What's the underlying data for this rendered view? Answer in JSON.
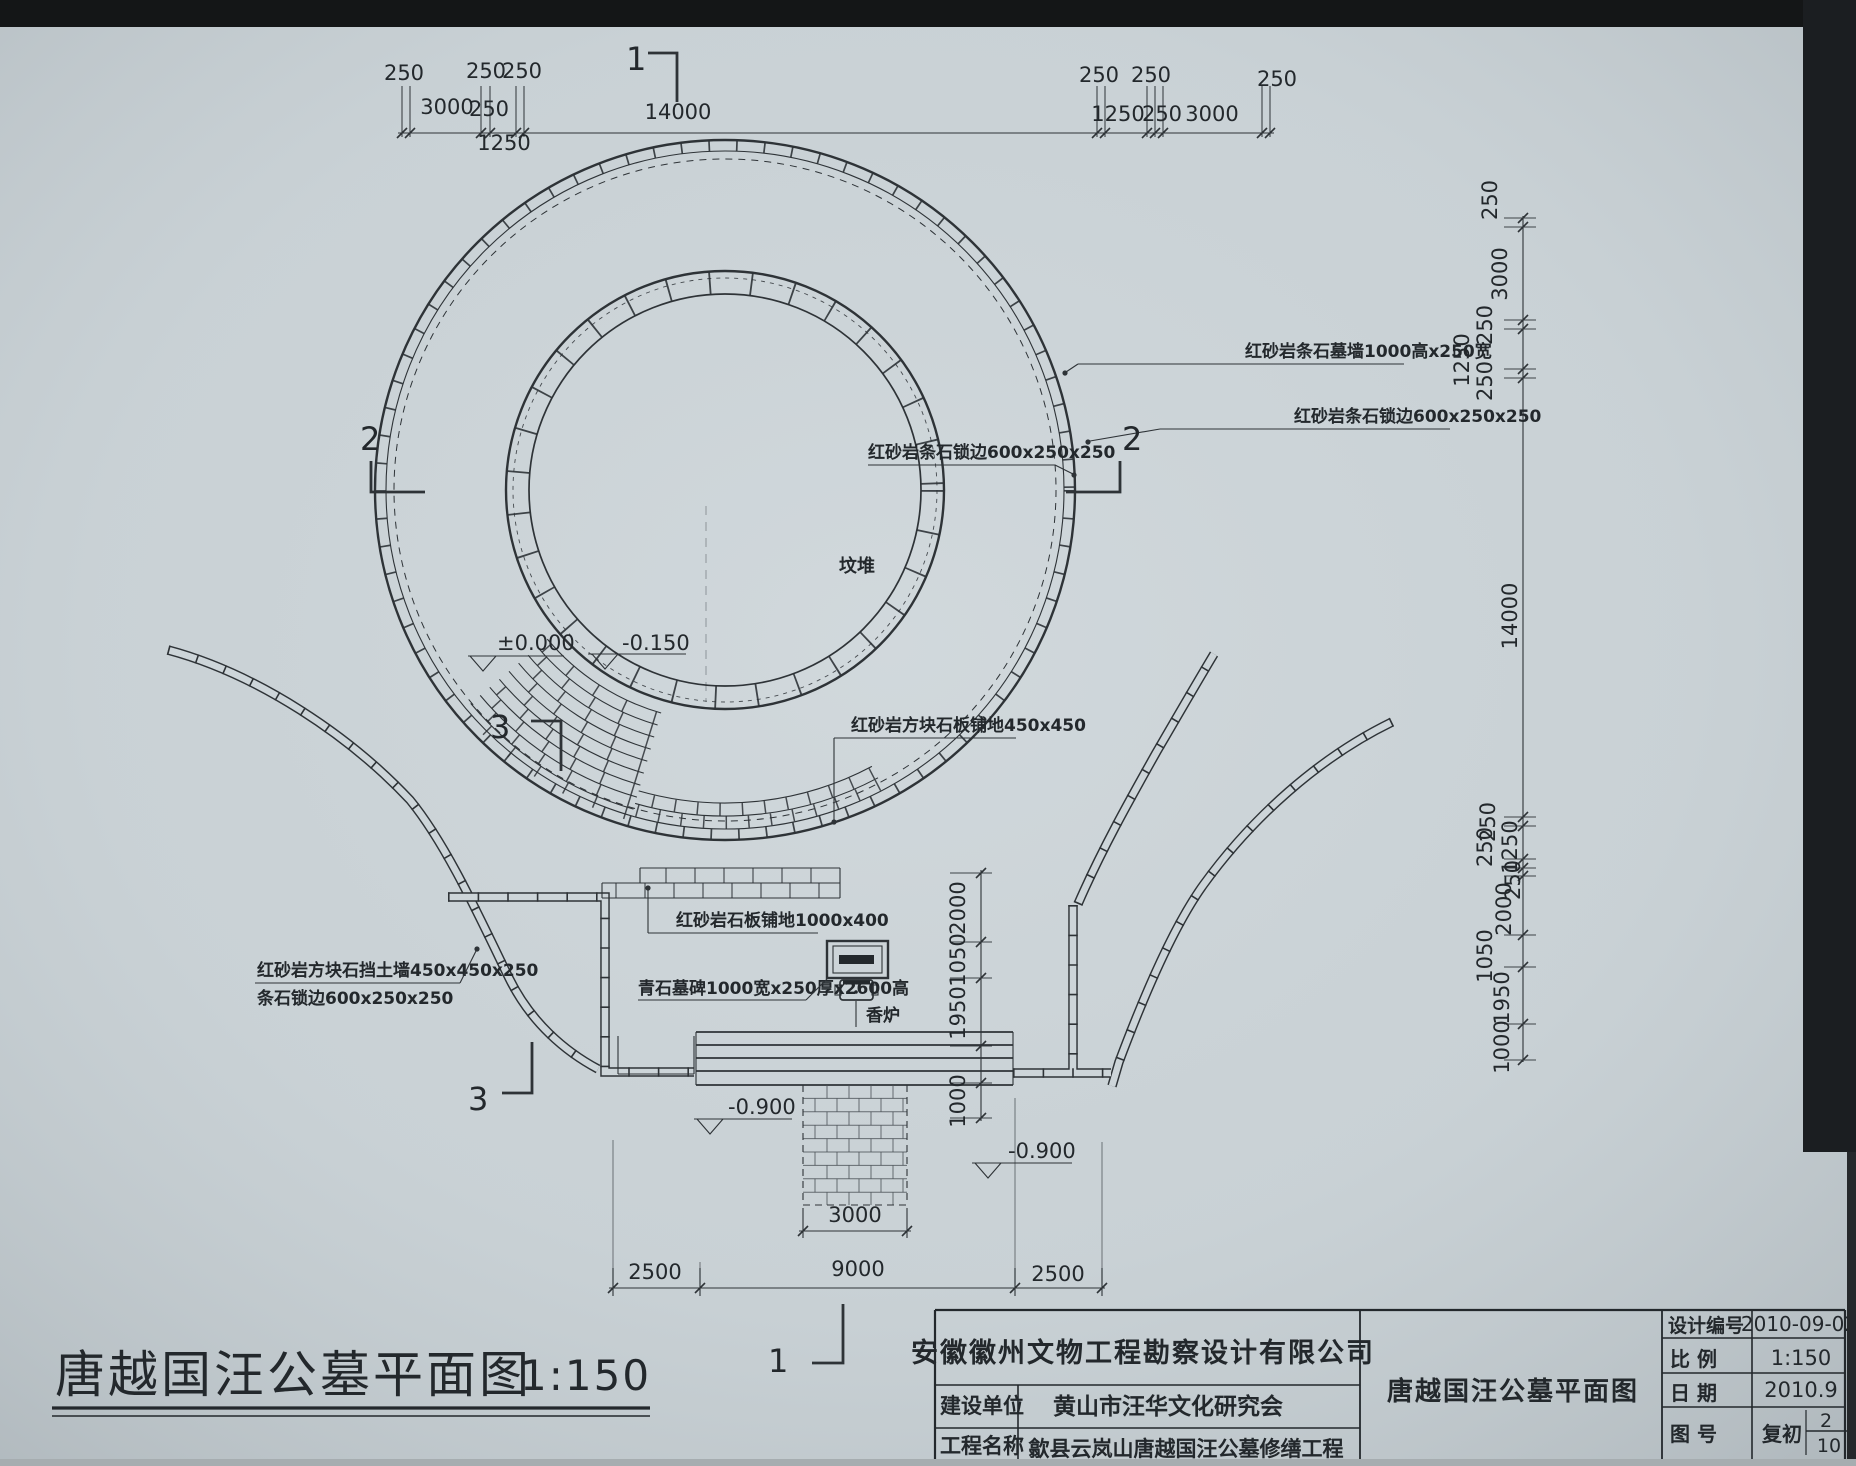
{
  "colors": {
    "paper": "#cdd5d9",
    "ink": "#2e3337",
    "edge_band": "#16181a"
  },
  "sheet": {
    "title": "唐越国汪公墓平面图",
    "scale_note": "1:150"
  },
  "plan": {
    "mound_label": {
      "text": "坟堆",
      "x": 857,
      "y": 572
    },
    "material_labels": [
      {
        "text": "红砂岩条石墓墙1000高x250宽",
        "x": 1245,
        "y": 357,
        "underline": [
          1078,
          364,
          1404,
          364
        ],
        "leader": [
          [
            1078,
            364
          ],
          [
            1066,
            372
          ]
        ],
        "dot": [
          1065,
          373
        ]
      },
      {
        "text": "红砂岩条石锁边600x250x250",
        "x": 1294,
        "y": 422,
        "underline": [
          1160,
          429,
          1450,
          429
        ],
        "leader": [
          [
            1160,
            429
          ],
          [
            1090,
            441
          ]
        ],
        "dot": [
          1088,
          442
        ]
      },
      {
        "text": "红砂岩条石锁边600x250x250",
        "x": 868,
        "y": 458,
        "underline": [
          868,
          465,
          1055,
          465
        ],
        "leader": [
          [
            1055,
            465
          ],
          [
            1073,
            474
          ]
        ],
        "dot": [
          1074,
          475
        ]
      },
      {
        "text": "红砂岩方块石板铺地450x450",
        "x": 851,
        "y": 731,
        "underline": [
          834,
          738,
          1016,
          738
        ],
        "leader": [
          [
            834,
            738
          ],
          [
            834,
            820
          ]
        ],
        "dot": [
          834,
          822
        ]
      },
      {
        "text": "红砂岩石板铺地1000x400",
        "x": 676,
        "y": 926,
        "underline": [
          648,
          933,
          818,
          933
        ],
        "leader": [
          [
            648,
            933
          ],
          [
            648,
            889
          ]
        ],
        "dot": [
          648,
          888
        ]
      },
      {
        "text": "青石墓碑1000宽x250厚x2600高",
        "x": 638,
        "y": 994,
        "underline": [
          638,
          1000,
          806,
          1000
        ],
        "leader": [
          [
            806,
            1000
          ],
          [
            828,
            978
          ]
        ]
      },
      {
        "text": "香炉",
        "x": 866,
        "y": 1021,
        "leader": [
          [
            856,
            1001
          ],
          [
            856,
            1027
          ]
        ]
      },
      {
        "text": "红砂岩方块石挡土墙450x450x250",
        "x": 257,
        "y": 976,
        "underline": [
          255,
          983,
          460,
          983
        ],
        "leader": [
          [
            460,
            983
          ],
          [
            476,
            951
          ]
        ],
        "dot": [
          477,
          949
        ]
      },
      {
        "text": "条石锁边600x250x250",
        "x": 257,
        "y": 1004
      }
    ],
    "elevation_marks": [
      {
        "text": "±0.000",
        "x": 497,
        "y": 650,
        "lx1": 468,
        "lx2": 564,
        "ly": 656,
        "tx": 470
      },
      {
        "text": "-0.150",
        "x": 622,
        "y": 650,
        "lx1": 588,
        "lx2": 686,
        "ly": 654,
        "tx": 592
      },
      {
        "text": "-0.900",
        "x": 728,
        "y": 1114,
        "lx1": 694,
        "lx2": 792,
        "ly": 1119,
        "tx": 697
      },
      {
        "text": "-0.900",
        "x": 1008,
        "y": 1158,
        "lx1": 972,
        "lx2": 1072,
        "ly": 1163,
        "tx": 975
      }
    ],
    "section_markers": [
      {
        "text": "1",
        "x": 626,
        "y": 70,
        "bracket": [
          [
            648,
            53
          ],
          [
            677,
            53
          ],
          [
            677,
            102
          ]
        ]
      },
      {
        "text": "2",
        "x": 360,
        "y": 450,
        "bracket": [
          [
            371,
            461
          ],
          [
            371,
            492
          ],
          [
            425,
            492
          ]
        ]
      },
      {
        "text": "2",
        "x": 1122,
        "y": 450,
        "bracket": [
          [
            1120,
            461
          ],
          [
            1120,
            492
          ],
          [
            1066,
            492
          ]
        ]
      },
      {
        "text": "3",
        "x": 490,
        "y": 738,
        "bracket": [
          [
            531,
            721
          ],
          [
            561,
            721
          ],
          [
            561,
            771
          ]
        ]
      },
      {
        "text": "3",
        "x": 468,
        "y": 1110,
        "bracket": [
          [
            532,
            1042
          ],
          [
            532,
            1093
          ],
          [
            502,
            1093
          ]
        ]
      },
      {
        "text": "1",
        "x": 768,
        "y": 1372,
        "bracket": [
          [
            843,
            1304
          ],
          [
            843,
            1363
          ],
          [
            812,
            1363
          ]
        ]
      }
    ]
  },
  "dimensions": {
    "top": {
      "values": [
        "250",
        "3000",
        "250",
        "1250",
        "250",
        "14000",
        "250",
        "1250",
        "250",
        "250",
        "3000",
        "250"
      ],
      "ticks": [
        402,
        410,
        481,
        490,
        516,
        524,
        1097,
        1105,
        1147,
        1155,
        1163,
        1262,
        1270
      ],
      "labels": [
        {
          "t": "250",
          "x": 404,
          "y": 80
        },
        {
          "t": "3000",
          "x": 447,
          "y": 114
        },
        {
          "t": "250",
          "x": 486,
          "y": 78
        },
        {
          "t": "250",
          "x": 489,
          "y": 116
        },
        {
          "t": "1250",
          "x": 504,
          "y": 150
        },
        {
          "t": "250",
          "x": 522,
          "y": 78
        },
        {
          "t": "14000",
          "x": 678,
          "y": 119
        },
        {
          "t": "250",
          "x": 1099,
          "y": 82
        },
        {
          "t": "1250",
          "x": 1118,
          "y": 121
        },
        {
          "t": "250",
          "x": 1151,
          "y": 82
        },
        {
          "t": "250",
          "x": 1162,
          "y": 121
        },
        {
          "t": "3000",
          "x": 1212,
          "y": 121
        },
        {
          "t": "250",
          "x": 1277,
          "y": 86
        }
      ]
    },
    "bottom": {
      "values": [
        "2500",
        "9000",
        "2500"
      ],
      "ticks": [
        613,
        700,
        1015,
        1102
      ],
      "labels": [
        {
          "t": "2500",
          "x": 655,
          "y": 1279
        },
        {
          "t": "9000",
          "x": 858,
          "y": 1276
        },
        {
          "t": "2500",
          "x": 1058,
          "y": 1281
        }
      ]
    },
    "gate": {
      "values": [
        "3000"
      ],
      "ticks": [
        803,
        907
      ],
      "labels": [
        {
          "t": "3000",
          "x": 855,
          "y": 1222
        }
      ]
    },
    "court": {
      "values": [
        "2000",
        "1050",
        "1950",
        "1000"
      ],
      "ticks": [
        873,
        942,
        978,
        1046,
        1083,
        1118
      ],
      "labels": [
        {
          "t": "2000",
          "x": 965,
          "y": 908
        },
        {
          "t": "1050",
          "x": 965,
          "y": 960
        },
        {
          "t": "1950",
          "x": 965,
          "y": 1013
        },
        {
          "t": "1000",
          "x": 965,
          "y": 1101
        }
      ]
    },
    "right": {
      "values": [
        "250",
        "3000",
        "250",
        "1250",
        "250",
        "14000",
        "250",
        "250",
        "1250",
        "250",
        "2000",
        "1050",
        "1950",
        "1000"
      ],
      "ticks": [
        218,
        227,
        320,
        329,
        369,
        378,
        817,
        826,
        859,
        868,
        876,
        935,
        967,
        1024,
        1060
      ],
      "labels": [
        {
          "t": "250",
          "x": 1497,
          "y": 200
        },
        {
          "t": "3000",
          "x": 1507,
          "y": 274
        },
        {
          "t": "250",
          "x": 1492,
          "y": 325
        },
        {
          "t": "1250",
          "x": 1469,
          "y": 360
        },
        {
          "t": "250",
          "x": 1492,
          "y": 381
        },
        {
          "t": "14000",
          "x": 1517,
          "y": 616
        },
        {
          "t": "250",
          "x": 1495,
          "y": 822
        },
        {
          "t": "250",
          "x": 1492,
          "y": 847
        },
        {
          "t": "1250",
          "x": 1517,
          "y": 847
        },
        {
          "t": "250",
          "x": 1520,
          "y": 880
        },
        {
          "t": "2000",
          "x": 1511,
          "y": 909
        },
        {
          "t": "1050",
          "x": 1492,
          "y": 956
        },
        {
          "t": "1950",
          "x": 1509,
          "y": 998
        },
        {
          "t": "1000",
          "x": 1509,
          "y": 1047
        }
      ]
    }
  },
  "titleblock": {
    "company": "安徽徽州文物工程勘察设计有限公司",
    "client_label": "建设单位",
    "client": "黄山市汪华文化研究会",
    "project_label": "工程名称",
    "project": "歙县云岚山唐越国汪公墓修缮工程",
    "drawing_name": "唐越国汪公墓平面图",
    "design_no_label": "设计编号",
    "design_no": "2010-09-02",
    "scale_label": "比  例",
    "scale": "1:150",
    "date_label": "日  期",
    "date": "2010.9",
    "sheet_label": "图  号",
    "sheet_prefix": "复初",
    "sheet_num": "2",
    "sheet_total": "10"
  }
}
